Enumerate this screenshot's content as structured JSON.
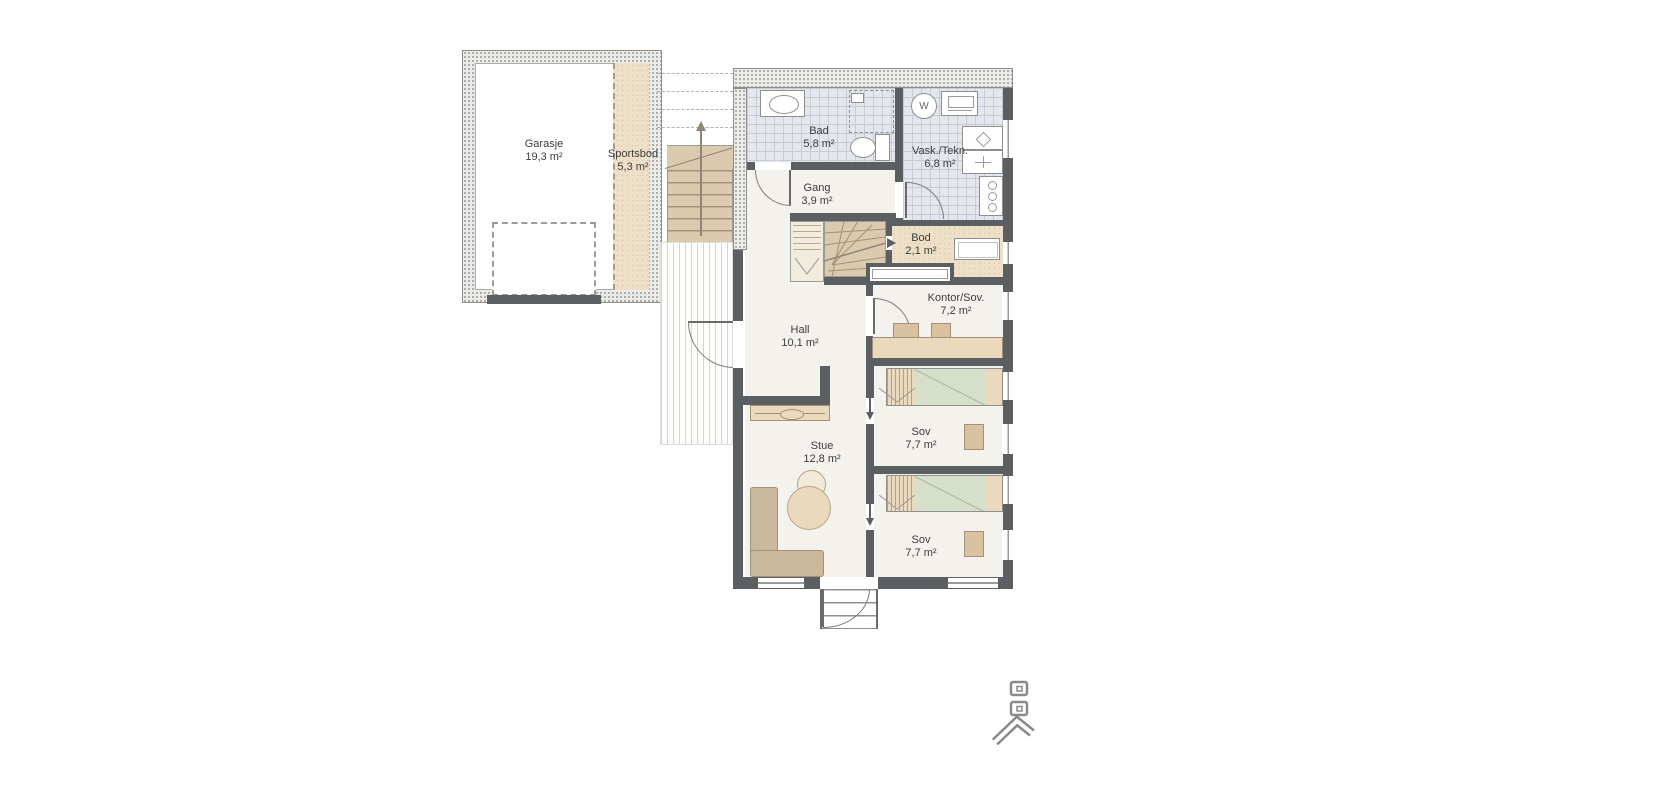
{
  "plan": {
    "type": "residential-floor-plan",
    "rooms": {
      "garasje": {
        "label": "Garasje",
        "area": "19,3 m²"
      },
      "sportsbod": {
        "label": "Sportsbod",
        "area": "5,3 m²"
      },
      "bad": {
        "label": "Bad",
        "area": "5,8 m²"
      },
      "vask_tekn": {
        "label": "Vask./Tekn.",
        "area": "6,8 m²"
      },
      "gang": {
        "label": "Gang",
        "area": "3,9 m²"
      },
      "bod": {
        "label": "Bod",
        "area": "2,1 m²"
      },
      "kontor_sov": {
        "label": "Kontor/Sov.",
        "area": "7,2 m²"
      },
      "hall": {
        "label": "Hall",
        "area": "10,1 m²"
      },
      "stue": {
        "label": "Stue",
        "area": "12,8 m²"
      },
      "sov1": {
        "label": "Sov",
        "area": "7,7 m²"
      },
      "sov2": {
        "label": "Sov",
        "area": "7,7 m²"
      }
    },
    "icons": {
      "washing_machine_label": "W"
    },
    "colors": {
      "exterior_wall": "#ebebe9",
      "interior_wall": "#5c5f62",
      "tile_floor": "#e3e6ec",
      "wood_floor": "#eee0c8",
      "stair_tread": "#dbcaae",
      "furniture": "#ead9bc",
      "sofa": "#cbb89c",
      "duvet": "#d5dfca",
      "label_text": "#3c3c3c"
    }
  }
}
